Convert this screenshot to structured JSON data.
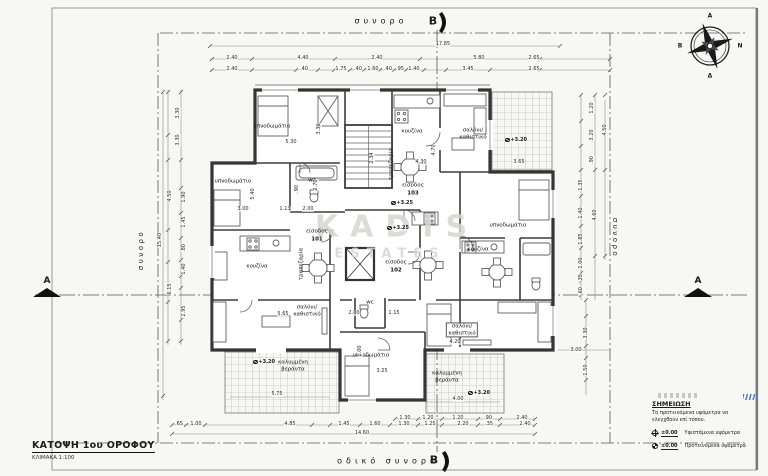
{
  "sheet": {
    "title": "ΚΑΤΟΨΗ 1ου ΟΡΟΦΟΥ",
    "scale": "ΚΛΙΜΑΚΑ 1:100"
  },
  "watermark": {
    "line1": "KADIS",
    "line2": "ESTATES"
  },
  "compass": {
    "top": "Α",
    "left": "Β",
    "right": "Ν",
    "bottom": "Δ"
  },
  "sections": {
    "a": "A",
    "b": "B"
  },
  "boundaries": {
    "top": "συνορο",
    "left": "συνορο",
    "right": "συνορο",
    "bottom": "οδικό συνορο"
  },
  "legend": {
    "heading": "ΣΗΜΕΙΩΣΗ",
    "note": "Τα προτεινόμενα υψόμετρα να\nελεγχθούν επί τόπου.",
    "rows": [
      {
        "value": "±0.00",
        "label": "Υφιστάμενα υψόμετρα"
      },
      {
        "value": "±0.00",
        "label": "Προτεινόμενα υψόμετρα"
      }
    ]
  },
  "room_labels": [
    {
      "t": "υπνοδωμάτιο",
      "x": 272,
      "y": 127
    },
    {
      "t": "υπνοδωμάτιο",
      "x": 233,
      "y": 182
    },
    {
      "t": "υπνοδωμάτιο",
      "x": 508,
      "y": 226
    },
    {
      "t": "υπνοδωμάτιο",
      "x": 371,
      "y": 356
    },
    {
      "t": "κουζίνα",
      "x": 412,
      "y": 132
    },
    {
      "t": "κουζίνα",
      "x": 257,
      "y": 267
    },
    {
      "t": "κουζίνα",
      "x": 478,
      "y": 250
    },
    {
      "t": "σαλόνι/\nκαθιστικό",
      "x": 473,
      "y": 134
    },
    {
      "t": "σαλόνι/\nκαθιστικό",
      "x": 307,
      "y": 311
    },
    {
      "t": "σαλόνι/\nκαθιστικό",
      "x": 462,
      "y": 330,
      "box": 1
    },
    {
      "t": "τραπεζαρία",
      "x": 302,
      "y": 264,
      "r": 1
    },
    {
      "t": "τραπεζαρία",
      "x": 392,
      "y": 164,
      "r": 1
    },
    {
      "t": "είσοδος",
      "x": 317,
      "y": 232
    },
    {
      "t": "101",
      "x": 317,
      "y": 240,
      "b": 1
    },
    {
      "t": "είσοδος",
      "x": 396,
      "y": 263
    },
    {
      "t": "102",
      "x": 396,
      "y": 271,
      "b": 1
    },
    {
      "t": "είσοδος",
      "x": 413,
      "y": 186
    },
    {
      "t": "103",
      "x": 413,
      "y": 194,
      "b": 1
    },
    {
      "t": "wc",
      "x": 312,
      "y": 181
    },
    {
      "t": "wc",
      "x": 370,
      "y": 303
    },
    {
      "t": "καλυμμένη\nβεράντα",
      "x": 293,
      "y": 366
    },
    {
      "t": "καλυμμένη\nβεράντα",
      "x": 447,
      "y": 377
    }
  ],
  "level_marks": [
    {
      "t": "+3.20",
      "x": 516,
      "y": 140
    },
    {
      "t": "+3.25",
      "x": 402,
      "y": 203
    },
    {
      "t": "+3.25",
      "x": 398,
      "y": 228
    },
    {
      "t": "+3.20",
      "x": 264,
      "y": 362
    },
    {
      "t": "+3.20",
      "x": 479,
      "y": 393
    }
  ],
  "dims": [
    {
      "t": "17.85",
      "x": 443,
      "y": 44
    },
    {
      "t": "2.40",
      "x": 232,
      "y": 58
    },
    {
      "t": "4.40",
      "x": 303,
      "y": 58
    },
    {
      "t": "2.40",
      "x": 377,
      "y": 58
    },
    {
      "t": "5.80",
      "x": 479,
      "y": 58
    },
    {
      "t": "2.65",
      "x": 534,
      "y": 58
    },
    {
      "t": "2.40",
      "x": 232,
      "y": 69
    },
    {
      "t": ".40",
      "x": 304,
      "y": 69
    },
    {
      "t": "1.75",
      "x": 341,
      "y": 69
    },
    {
      "t": ".40",
      "x": 358,
      "y": 69
    },
    {
      "t": "1.60",
      "x": 373,
      "y": 69
    },
    {
      "t": ".40",
      "x": 388,
      "y": 69
    },
    {
      "t": ".95",
      "x": 400,
      "y": 69
    },
    {
      "t": "1.40",
      "x": 414,
      "y": 69
    },
    {
      "t": "3.45",
      "x": 468,
      "y": 69
    },
    {
      "t": "2.65",
      "x": 534,
      "y": 69
    },
    {
      "t": "3.30",
      "x": 178,
      "y": 113,
      "r": 1
    },
    {
      "t": "3.30",
      "x": 178,
      "y": 140,
      "r": 1
    },
    {
      "t": "4.50",
      "x": 170,
      "y": 196,
      "r": 1
    },
    {
      "t": "1.90",
      "x": 184,
      "y": 197,
      "r": 1
    },
    {
      "t": "1.45",
      "x": 184,
      "y": 222,
      "r": 1
    },
    {
      "t": ".80",
      "x": 184,
      "y": 248,
      "r": 1
    },
    {
      "t": "1.40",
      "x": 184,
      "y": 269,
      "r": 1
    },
    {
      "t": "6.15",
      "x": 170,
      "y": 289,
      "r": 1
    },
    {
      "t": "2.95",
      "x": 184,
      "y": 311,
      "r": 1
    },
    {
      "t": "15.40",
      "x": 160,
      "y": 240,
      "r": 1
    },
    {
      "t": "1.20",
      "x": 592,
      "y": 108,
      "r": 1
    },
    {
      "t": "3.20",
      "x": 592,
      "y": 135,
      "r": 1
    },
    {
      "t": "4.50",
      "x": 605,
      "y": 130,
      "r": 1
    },
    {
      "t": ".90",
      "x": 592,
      "y": 160,
      "r": 1
    },
    {
      "t": "1.35",
      "x": 581,
      "y": 185,
      "r": 1
    },
    {
      "t": "1.40",
      "x": 581,
      "y": 213,
      "r": 1
    },
    {
      "t": "4.60",
      "x": 595,
      "y": 215,
      "r": 1
    },
    {
      "t": "1.85",
      "x": 581,
      "y": 239,
      "r": 1
    },
    {
      "t": "1.00",
      "x": 581,
      "y": 263,
      "r": 1
    },
    {
      "t": ".35",
      "x": 581,
      "y": 278,
      "r": 1
    },
    {
      "t": ".60",
      "x": 581,
      "y": 291,
      "r": 1
    },
    {
      "t": "3.30",
      "x": 586,
      "y": 333,
      "r": 1
    },
    {
      "t": "3.00",
      "x": 576,
      "y": 350
    },
    {
      "t": "1.50",
      "x": 586,
      "y": 370,
      "r": 1
    },
    {
      "t": "1.30",
      "x": 405,
      "y": 418
    },
    {
      "t": "1.20",
      "x": 428,
      "y": 418
    },
    {
      "t": "1.20",
      "x": 458,
      "y": 418
    },
    {
      "t": ".90",
      "x": 488,
      "y": 418
    },
    {
      "t": "2.40",
      "x": 522,
      "y": 418
    },
    {
      "t": ".65",
      "x": 179,
      "y": 424
    },
    {
      "t": "1.00",
      "x": 196,
      "y": 424
    },
    {
      "t": "4.85",
      "x": 290,
      "y": 424
    },
    {
      "t": "1.45",
      "x": 344,
      "y": 424
    },
    {
      "t": "1.60",
      "x": 375,
      "y": 424
    },
    {
      "t": "1.30",
      "x": 404,
      "y": 424
    },
    {
      "t": "1.25",
      "x": 430,
      "y": 424
    },
    {
      "t": "2.20",
      "x": 463,
      "y": 424
    },
    {
      "t": ".35",
      "x": 489,
      "y": 424
    },
    {
      "t": "2.40",
      "x": 525,
      "y": 424
    },
    {
      "t": "14.60",
      "x": 362,
      "y": 433
    },
    {
      "t": "5.30",
      "x": 291,
      "y": 142
    },
    {
      "t": "3.30",
      "x": 319,
      "y": 129,
      "r": 1
    },
    {
      "t": "5.40",
      "x": 253,
      "y": 194,
      "r": 1
    },
    {
      "t": "3.00",
      "x": 243,
      "y": 209
    },
    {
      "t": "1.13",
      "x": 285,
      "y": 209
    },
    {
      "t": "2.00",
      "x": 308,
      "y": 209
    },
    {
      "t": "2.70",
      "x": 316,
      "y": 185,
      "r": 1
    },
    {
      "t": ".90",
      "x": 297,
      "y": 189,
      "r": 1
    },
    {
      "t": "2.34",
      "x": 372,
      "y": 158,
      "r": 1
    },
    {
      "t": "4.70",
      "x": 434,
      "y": 150,
      "r": 1
    },
    {
      "t": "4.30",
      "x": 421,
      "y": 162
    },
    {
      "t": "3.65",
      "x": 519,
      "y": 162
    },
    {
      "t": "5.65",
      "x": 283,
      "y": 314
    },
    {
      "t": "2.00",
      "x": 354,
      "y": 313
    },
    {
      "t": "1.15",
      "x": 394,
      "y": 313
    },
    {
      "t": "1.00",
      "x": 360,
      "y": 351,
      "r": 1
    },
    {
      "t": "3.25",
      "x": 382,
      "y": 371
    },
    {
      "t": "5.75",
      "x": 277,
      "y": 394
    },
    {
      "t": "4.20",
      "x": 455,
      "y": 342
    },
    {
      "t": "4.00",
      "x": 458,
      "y": 399
    }
  ]
}
